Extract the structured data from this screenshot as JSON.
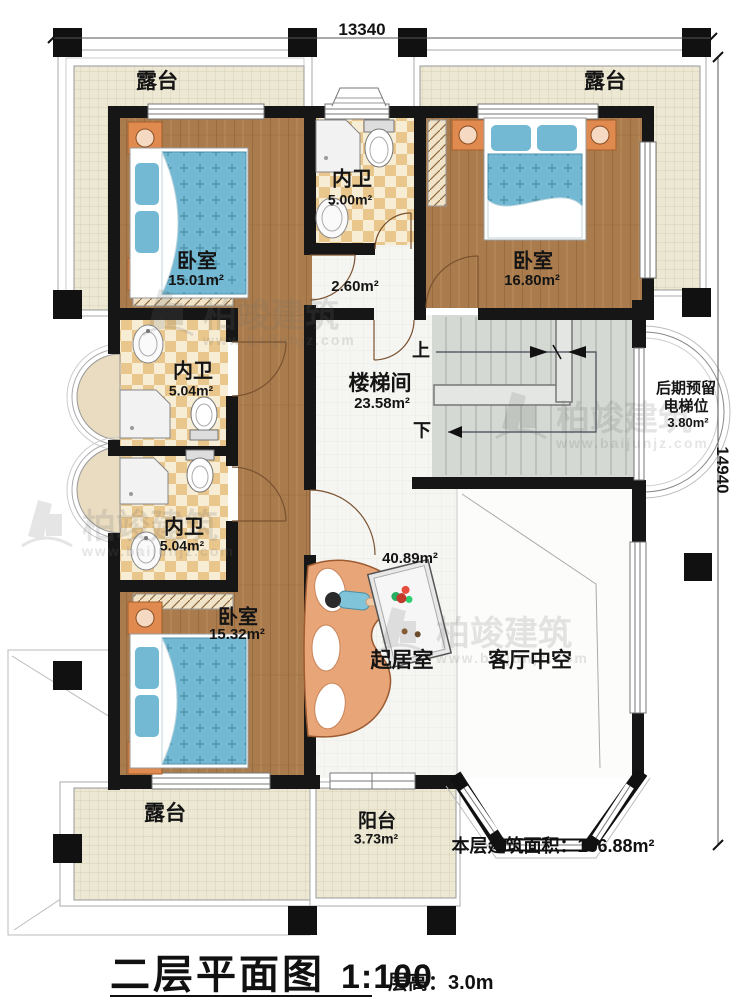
{
  "dimensions": {
    "top": "13340",
    "right": "14940"
  },
  "rooms": {
    "terrace_top_left": {
      "name": "露台"
    },
    "terrace_top_right": {
      "name": "露台"
    },
    "bedroom_top_left": {
      "name": "卧室",
      "area": "15.01m²"
    },
    "bathroom_top": {
      "name": "内卫",
      "area": "5.00m²"
    },
    "bedroom_top_right": {
      "name": "卧室",
      "area": "16.80m²"
    },
    "hallway": {
      "area": "2.60m²"
    },
    "bathroom_middle": {
      "name": "内卫",
      "area": "5.04m²"
    },
    "stairwell": {
      "name": "楼梯间",
      "area": "23.58m²"
    },
    "elevator_reserved": {
      "line1": "后期预留",
      "line2": "电梯位",
      "area": "3.80m²"
    },
    "bathroom_lower": {
      "name": "内卫",
      "area": "5.04m²"
    },
    "bedroom_bottom": {
      "name": "卧室",
      "area": "15.32m²"
    },
    "living_room": {
      "name": "起居室",
      "area": "40.89m²"
    },
    "living_void": {
      "name": "客厅中空"
    },
    "terrace_bottom": {
      "name": "露台"
    },
    "balcony": {
      "name": "阳台",
      "area": "3.73m²"
    }
  },
  "stairs": {
    "up": "上",
    "down": "下"
  },
  "notes": {
    "floor_area_label": "本层建筑面积：",
    "floor_area_value": "156.88m²"
  },
  "title": {
    "name": "二层平面图",
    "scale": "1:100",
    "floor_height": "层高：3.0m"
  },
  "watermark": {
    "brand": "柏竣建筑",
    "url": "www.baijunjz.com"
  },
  "colors": {
    "wall": "#161616",
    "wood_floor": "#aa7c4d",
    "bath_tile": "#e9c68c",
    "terrace": "#ece8d4",
    "bed": "#74b9d3",
    "sofa": "#e8a578",
    "stairs": "#d4d9d3",
    "nightstand": "#e08a50"
  }
}
